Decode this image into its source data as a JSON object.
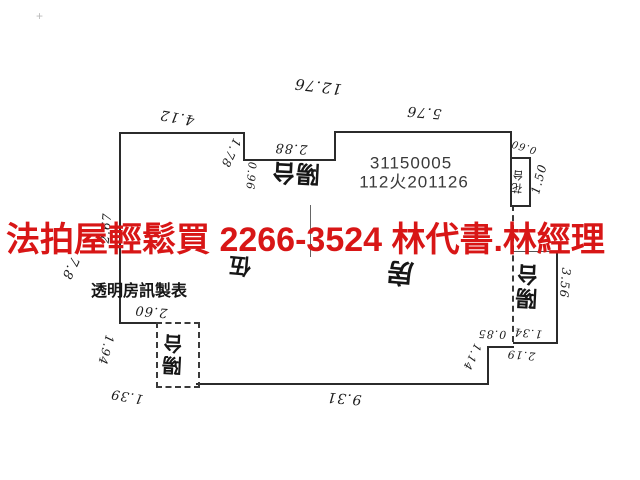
{
  "banner": {
    "text": "法拍屋輕鬆買  2266-3524  林代書.林經理",
    "color": "#d81616"
  },
  "plan": {
    "id_number": "31150005",
    "case_number": "112火201126",
    "credit": "透明房訊製表",
    "line_color": "#2b2b2b",
    "labels": [
      {
        "name": "dim-12-76",
        "text": "12.76",
        "x": 318,
        "y": 86,
        "rot": 187,
        "fs": 15,
        "cls": "hand"
      },
      {
        "name": "dim-4-12",
        "text": "4.12",
        "x": 177,
        "y": 117,
        "rot": 190,
        "fs": 14,
        "cls": "hand"
      },
      {
        "name": "dim-5-76",
        "text": "5.76",
        "x": 424,
        "y": 112,
        "rot": 185,
        "fs": 14,
        "cls": "hand"
      },
      {
        "name": "dim-2-88",
        "text": "2.88",
        "x": 291,
        "y": 148,
        "rot": 183,
        "fs": 13,
        "cls": "hand"
      },
      {
        "name": "dim-1-78",
        "text": "1.78",
        "x": 231,
        "y": 153,
        "rot": 115,
        "fs": 12,
        "cls": "hand"
      },
      {
        "name": "dim-0-96",
        "text": "0.96",
        "x": 251,
        "y": 176,
        "rot": 95,
        "fs": 11,
        "cls": "hand"
      },
      {
        "name": "dim-0-60",
        "text": "0.60",
        "x": 524,
        "y": 146,
        "rot": 197,
        "fs": 10,
        "cls": "hand"
      },
      {
        "name": "dim-1-50",
        "text": "1.50",
        "x": 539,
        "y": 179,
        "rot": 285,
        "fs": 12,
        "cls": "hand"
      },
      {
        "name": "dim-2-67",
        "text": "2.67",
        "x": 106,
        "y": 228,
        "rot": 275,
        "fs": 12,
        "cls": "hand"
      },
      {
        "name": "dim-7-8",
        "text": "7.8",
        "x": 70,
        "y": 268,
        "rot": 115,
        "fs": 13,
        "cls": "hand"
      },
      {
        "name": "dim-2-60",
        "text": "2.60",
        "x": 151,
        "y": 311,
        "rot": 185,
        "fs": 13,
        "cls": "hand"
      },
      {
        "name": "dim-1-94",
        "text": "1.94",
        "x": 106,
        "y": 350,
        "rot": 105,
        "fs": 12,
        "cls": "hand"
      },
      {
        "name": "dim-1-39",
        "text": "1.39",
        "x": 127,
        "y": 396,
        "rot": 190,
        "fs": 13,
        "cls": "hand"
      },
      {
        "name": "dim-9-31",
        "text": "9.31",
        "x": 344,
        "y": 398,
        "rot": 185,
        "fs": 14,
        "cls": "hand"
      },
      {
        "name": "dim-0-85",
        "text": "0.85",
        "x": 492,
        "y": 334,
        "rot": 182,
        "fs": 11,
        "cls": "hand"
      },
      {
        "name": "dim-1-34",
        "text": "1.34",
        "x": 528,
        "y": 333,
        "rot": 185,
        "fs": 11,
        "cls": "hand"
      },
      {
        "name": "dim-1-14",
        "text": "1.14",
        "x": 472,
        "y": 357,
        "rot": 115,
        "fs": 11,
        "cls": "hand"
      },
      {
        "name": "dim-2-19",
        "text": "2.19",
        "x": 521,
        "y": 355,
        "rot": 185,
        "fs": 11,
        "cls": "hand"
      },
      {
        "name": "dim-3-56",
        "text": "3.56",
        "x": 565,
        "y": 283,
        "rot": 95,
        "fs": 12,
        "cls": "hand"
      },
      {
        "name": "room-label-balcony-top",
        "text": "陽台",
        "x": 296,
        "y": 172,
        "rot": 183,
        "fs": 24,
        "bold": true,
        "cls": "cjk"
      },
      {
        "name": "room-label-unit-five",
        "text": "伍",
        "x": 240,
        "y": 265,
        "rot": 185,
        "fs": 22,
        "bold": true,
        "cls": "cjk"
      },
      {
        "name": "room-label-room",
        "text": "房",
        "x": 400,
        "y": 272,
        "rot": 185,
        "fs": 27,
        "bold": true,
        "cls": "cjk"
      },
      {
        "name": "room-label-balcony-right",
        "text": "陽台",
        "x": 529,
        "y": 286,
        "rot": 183,
        "fs": 22,
        "bold": true,
        "cls": "cjk vert"
      },
      {
        "name": "room-label-balcony-left",
        "text": "陽台",
        "x": 175,
        "y": 354,
        "rot": 183,
        "fs": 20,
        "bold": true,
        "cls": "cjk vert"
      },
      {
        "name": "room-label-planter",
        "text": "花台",
        "x": 519,
        "y": 181,
        "rot": 185,
        "fs": 11,
        "cls": "cjk vert"
      },
      {
        "name": "plan-id-number",
        "text": "31150005",
        "x": 411,
        "y": 163,
        "rot": 0,
        "fs": 17,
        "cls": "mono"
      },
      {
        "name": "case-number",
        "text": "112火201126",
        "x": 414,
        "y": 182,
        "rot": 0,
        "fs": 17,
        "cls": "mono"
      },
      {
        "name": "maker-credit",
        "text": "透明房訊製表",
        "x": 139,
        "y": 292,
        "rot": 0,
        "fs": 16,
        "bold": true,
        "cls": "cjk"
      }
    ]
  }
}
